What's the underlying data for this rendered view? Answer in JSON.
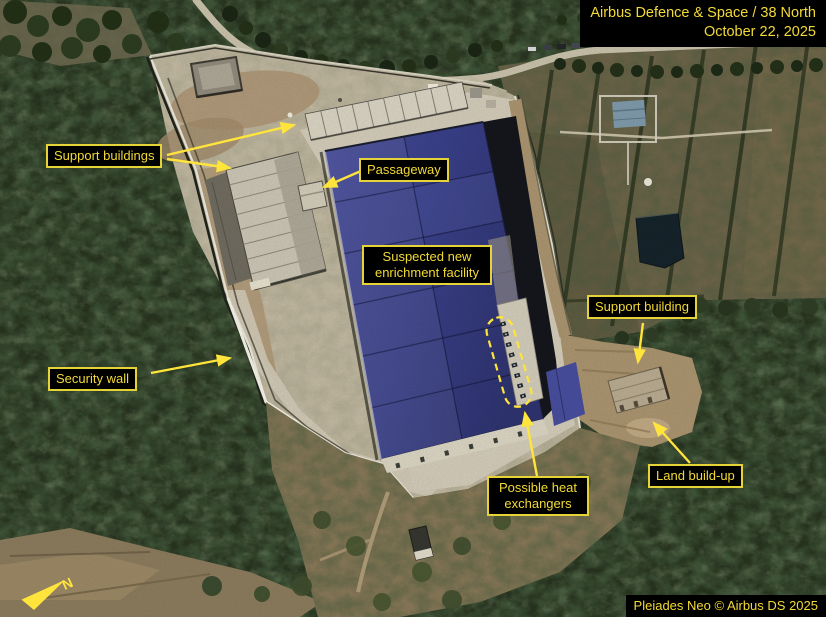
{
  "image": {
    "credit_line1": "Airbus Defence & Space / 38 North",
    "credit_line2": "October 22, 2025",
    "copyright": "Pleiades Neo © Airbus DS 2025"
  },
  "labels": {
    "support_buildings": "Support buildings",
    "passageway": "Passageway",
    "enrichment_facility": "Suspected new enrichment facility",
    "support_building": "Support building",
    "security_wall": "Security wall",
    "heat_exchangers": "Possible heat exchangers",
    "land_buildup": "Land build-up"
  },
  "compass": {
    "north_label": "N"
  },
  "colors": {
    "annotation_yellow": "#ffe43c",
    "label_text": "#f2da36",
    "label_background": "#000000",
    "roof_blue": "#3b4187",
    "forest_green": "#27331f",
    "concrete": "#c2b8a1"
  }
}
